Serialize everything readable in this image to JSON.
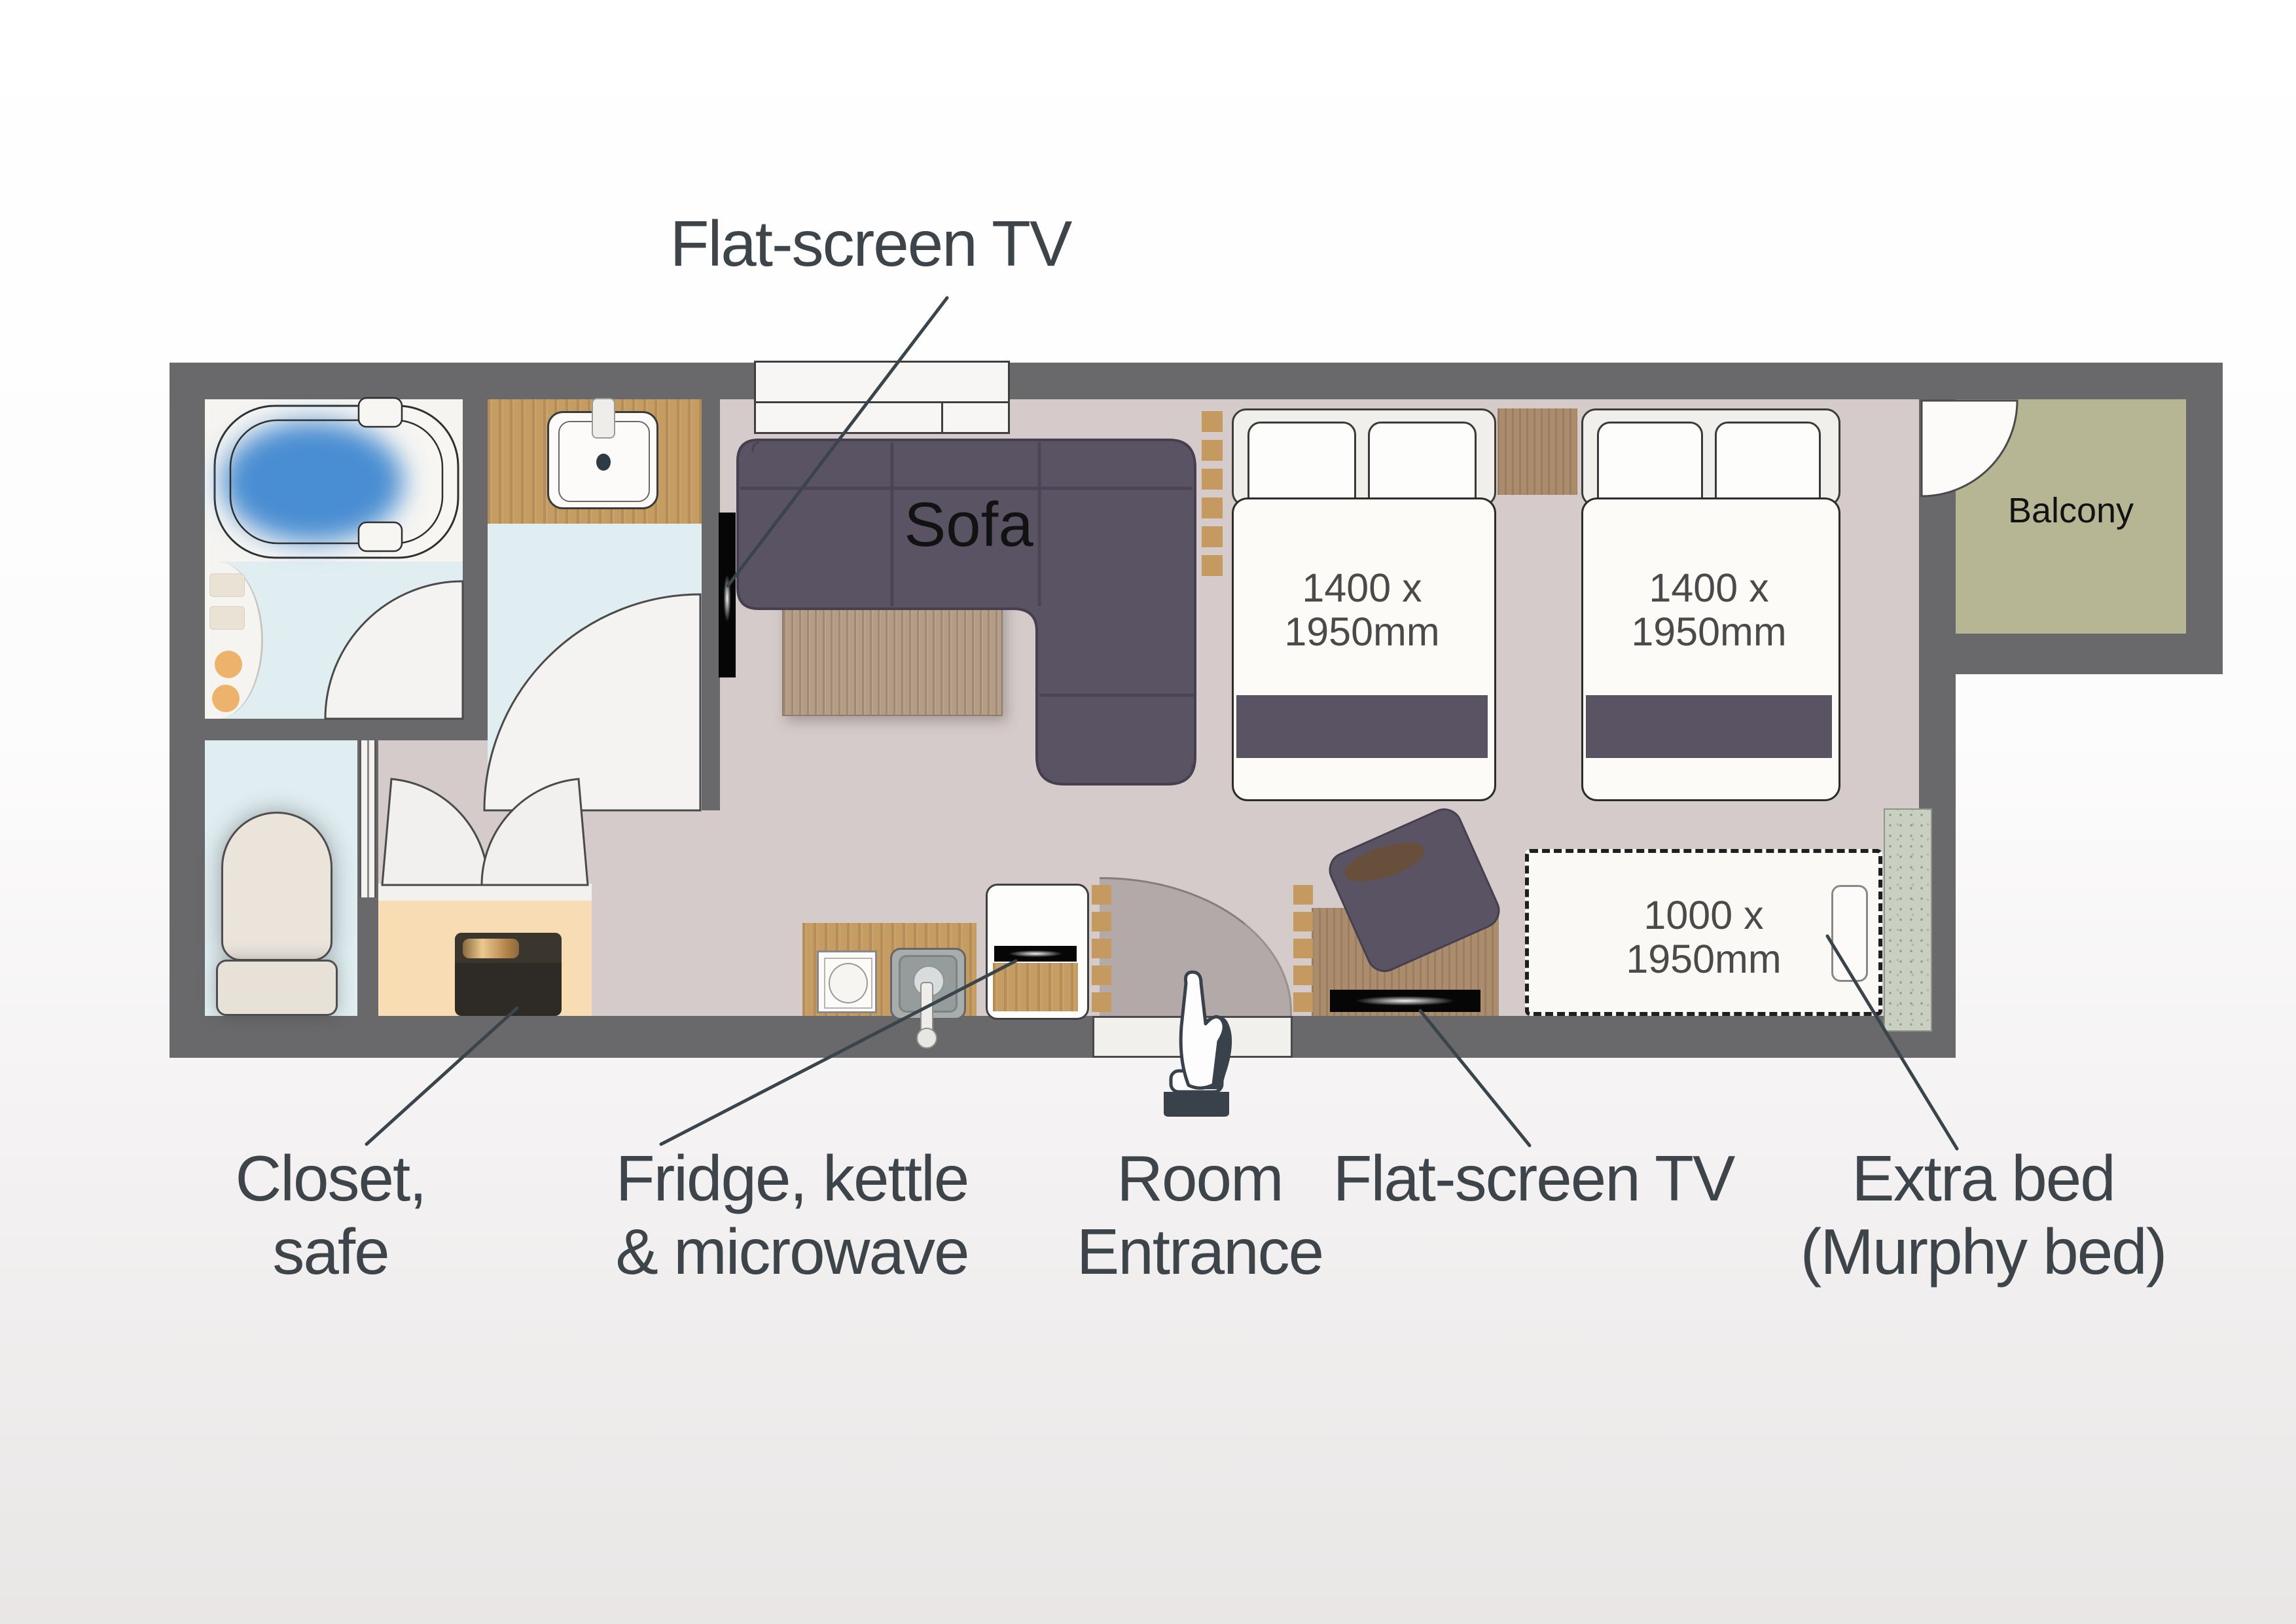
{
  "annotations": {
    "tv_top": "Flat-screen TV",
    "closet": {
      "line1": "Closet,",
      "line2": "safe"
    },
    "fridge": {
      "line1": "Fridge, kettle",
      "line2": "& microwave"
    },
    "entrance": {
      "line1": "Room",
      "line2": "Entrance"
    },
    "tv_bottom": "Flat-screen TV",
    "extra_bed": {
      "line1": "Extra bed",
      "line2": "(Murphy bed)"
    }
  },
  "rooms": {
    "sofa": "Sofa",
    "balcony": "Balcony"
  },
  "furniture": {
    "bed1": {
      "line1": "1400 x",
      "line2": "1950mm"
    },
    "bed2": {
      "line1": "1400 x",
      "line2": "1950mm"
    },
    "murphy_bed": {
      "line1": "1000 x",
      "line2": "1950mm"
    }
  },
  "icons": {
    "entrance_marker": "pointing-hand-statue-icon"
  },
  "colors": {
    "wall": "#69686a",
    "floor_main": "#d5cbca",
    "floor_entrance_alcove": "#b3a9a8",
    "floor_bathroom": "#f5f4f1",
    "floor_wet_blue": "#e0eef1",
    "floor_closet_peach": "#f8dcb4",
    "balcony_green": "#b6b695",
    "wood_oak": "#c59c62",
    "wood_furniture": "#ab8d6e",
    "upholstery_purple": "#5a5364",
    "bath_water_blue": "#4a8dd2",
    "label_text": "#3d444a",
    "leader_line": "#3a444b"
  }
}
